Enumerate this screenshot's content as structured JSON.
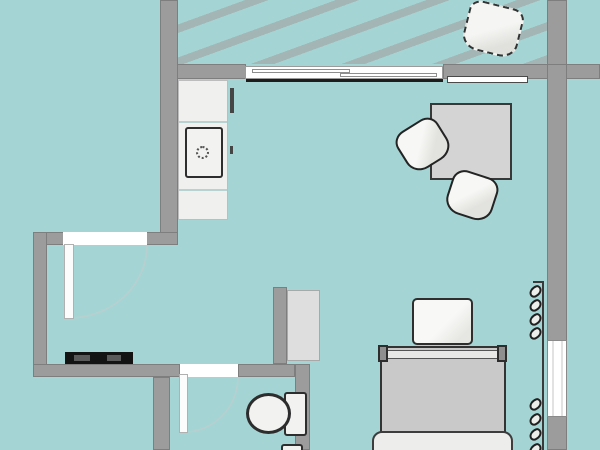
{
  "title": "Studio apartment floor plan",
  "colors": {
    "floor": "#a4d5d4",
    "balcony_stripe": "#a3b5b5",
    "wall": "#9c9c9c",
    "wall_edge": "#7e7e7e",
    "opening": "#ffffff",
    "outline": "#2e2e2e",
    "furniture_white": "#f2f2f0",
    "furniture_gray": "#d4d4d4",
    "mattress": "#c9c9c9",
    "tv_black": "#131313",
    "door_arc": "#b9cfcf"
  },
  "rooms": [
    "balcony",
    "kitchen",
    "living-room",
    "entry",
    "bathroom"
  ],
  "furniture": [
    {
      "name": "balcony-chair",
      "room": "balcony"
    },
    {
      "name": "kitchen-counter",
      "room": "kitchen"
    },
    {
      "name": "kitchen-sink",
      "room": "kitchen"
    },
    {
      "name": "dining-table",
      "room": "living-room"
    },
    {
      "name": "dining-chair",
      "room": "living-room",
      "count": 2
    },
    {
      "name": "wardrobe",
      "room": "living-room"
    },
    {
      "name": "bedside-table",
      "room": "living-room"
    },
    {
      "name": "bed",
      "room": "living-room"
    },
    {
      "name": "wall-hooks",
      "room": "living-room"
    },
    {
      "name": "tv-stand",
      "room": "entry"
    },
    {
      "name": "toilet",
      "room": "bathroom"
    },
    {
      "name": "bathroom-sink",
      "room": "bathroom"
    }
  ],
  "openings": {
    "entry_door": "hinged, swings into entry",
    "bathroom_door": "hinged, swings into bathroom",
    "balcony_door": "sliding, two panels",
    "windows": [
      "right wall window",
      "balcony wall window strip"
    ]
  },
  "hooks": {
    "y_offsets": [
      5,
      19,
      33,
      47,
      118,
      133,
      148,
      163
    ]
  }
}
